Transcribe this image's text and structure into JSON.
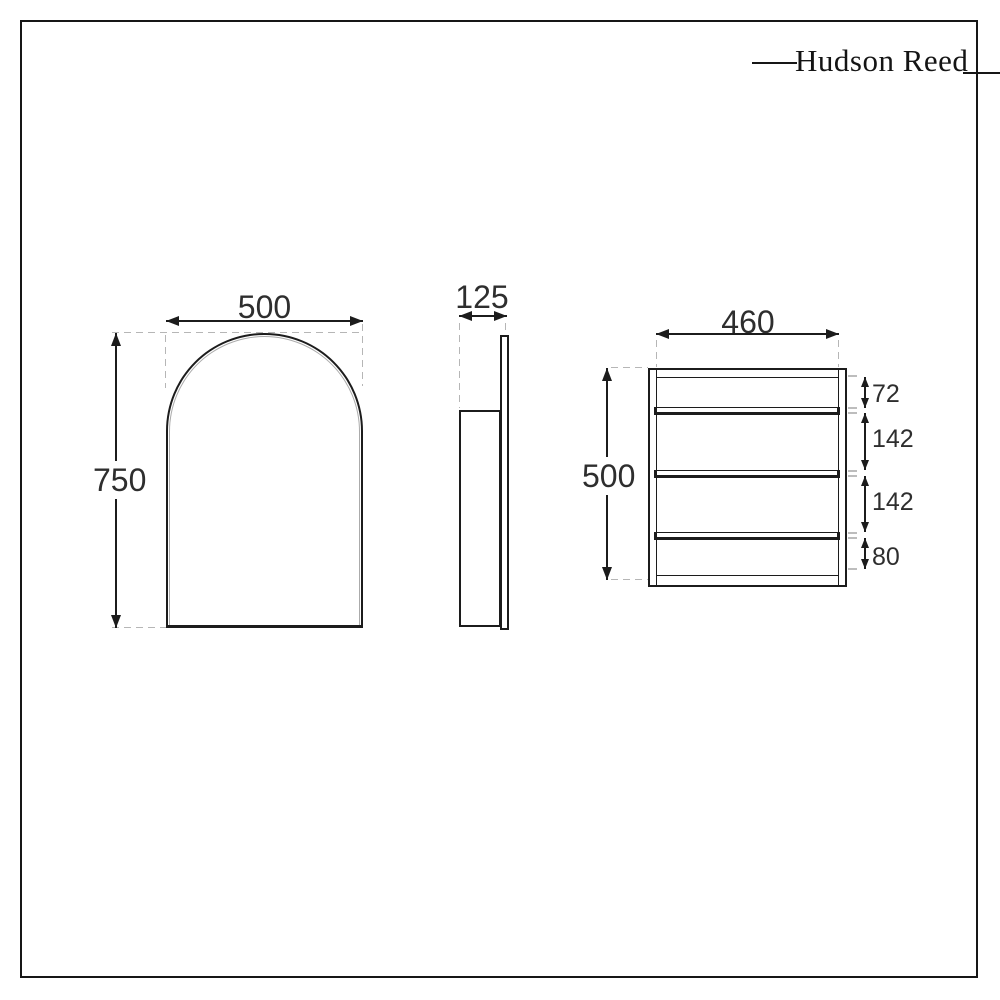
{
  "brand": {
    "logo_text": "Hudson Reed"
  },
  "views": {
    "front": {
      "width_label": "500",
      "height_label": "750"
    },
    "side": {
      "depth_label": "125"
    },
    "interior": {
      "width_label": "460",
      "height_label": "500",
      "shelf_count": 3,
      "segment_labels": [
        "72",
        "142",
        "142",
        "80"
      ]
    }
  },
  "colors": {
    "line": "#1c1c1c",
    "dash": "#b6b6b6",
    "background": "#ffffff"
  }
}
